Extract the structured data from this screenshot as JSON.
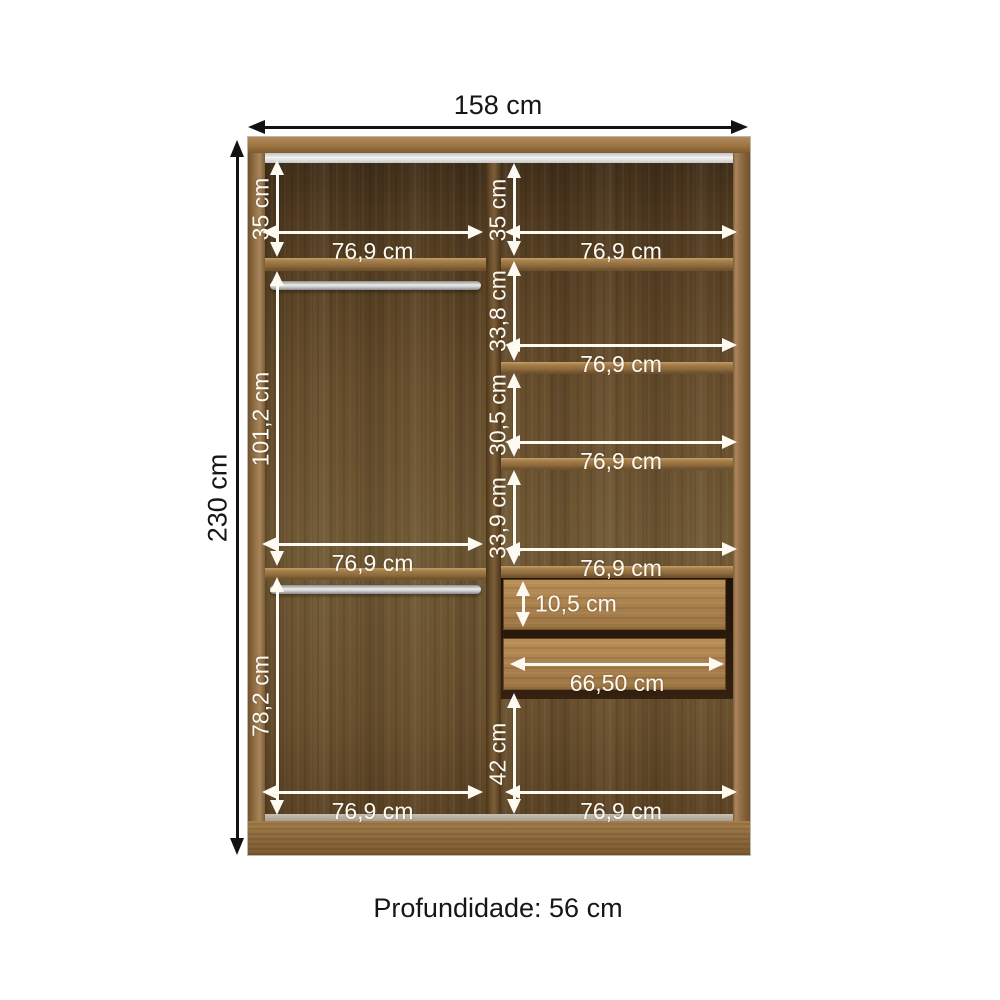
{
  "dims": {
    "total_width": "158 cm",
    "total_height": "230 cm",
    "depth": "Profundidade: 56 cm",
    "left": {
      "shelf_height": "35 cm",
      "top_width": "76,9 cm",
      "upper_height": "101,2 cm",
      "mid_width": "76,9 cm",
      "lower_height": "78,2 cm",
      "bottom_width": "76,9 cm"
    },
    "right": {
      "shelf_height": "35 cm",
      "top_width": "76,9 cm",
      "gap1": "33,8 cm",
      "width1": "76,9 cm",
      "gap2": "30,5 cm",
      "width2": "76,9 cm",
      "gap3": "33,9 cm",
      "width3": "76,9 cm",
      "drawer_height": "10,5 cm",
      "drawer_width": "66,50 cm",
      "bottom_height": "42 cm",
      "bottom_width": "76,9 cm"
    }
  },
  "colors": {
    "dimension_line_white": "#fdfaf2",
    "dimension_line_black": "#121212",
    "wood_frame": "#9a733f",
    "wood_back_panel": "#664d2c",
    "drawer_front": "#ad8450",
    "rail_silver": "#e0e0e0",
    "background": "#ffffff"
  }
}
